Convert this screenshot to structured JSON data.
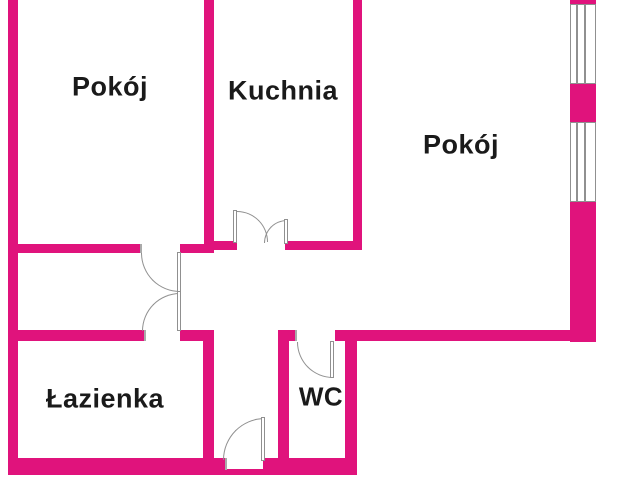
{
  "floorplan": {
    "wall_color": "#e0137c",
    "line_color": "#909090",
    "label_color": "#1a1a1a",
    "rooms": [
      {
        "name": "room-top-left",
        "label": "Pokój"
      },
      {
        "name": "kitchen",
        "label": "Kuchnia"
      },
      {
        "name": "room-right",
        "label": "Pokój"
      },
      {
        "name": "bathroom",
        "label": "Łazienka"
      },
      {
        "name": "toilet",
        "label": "WC"
      }
    ]
  }
}
